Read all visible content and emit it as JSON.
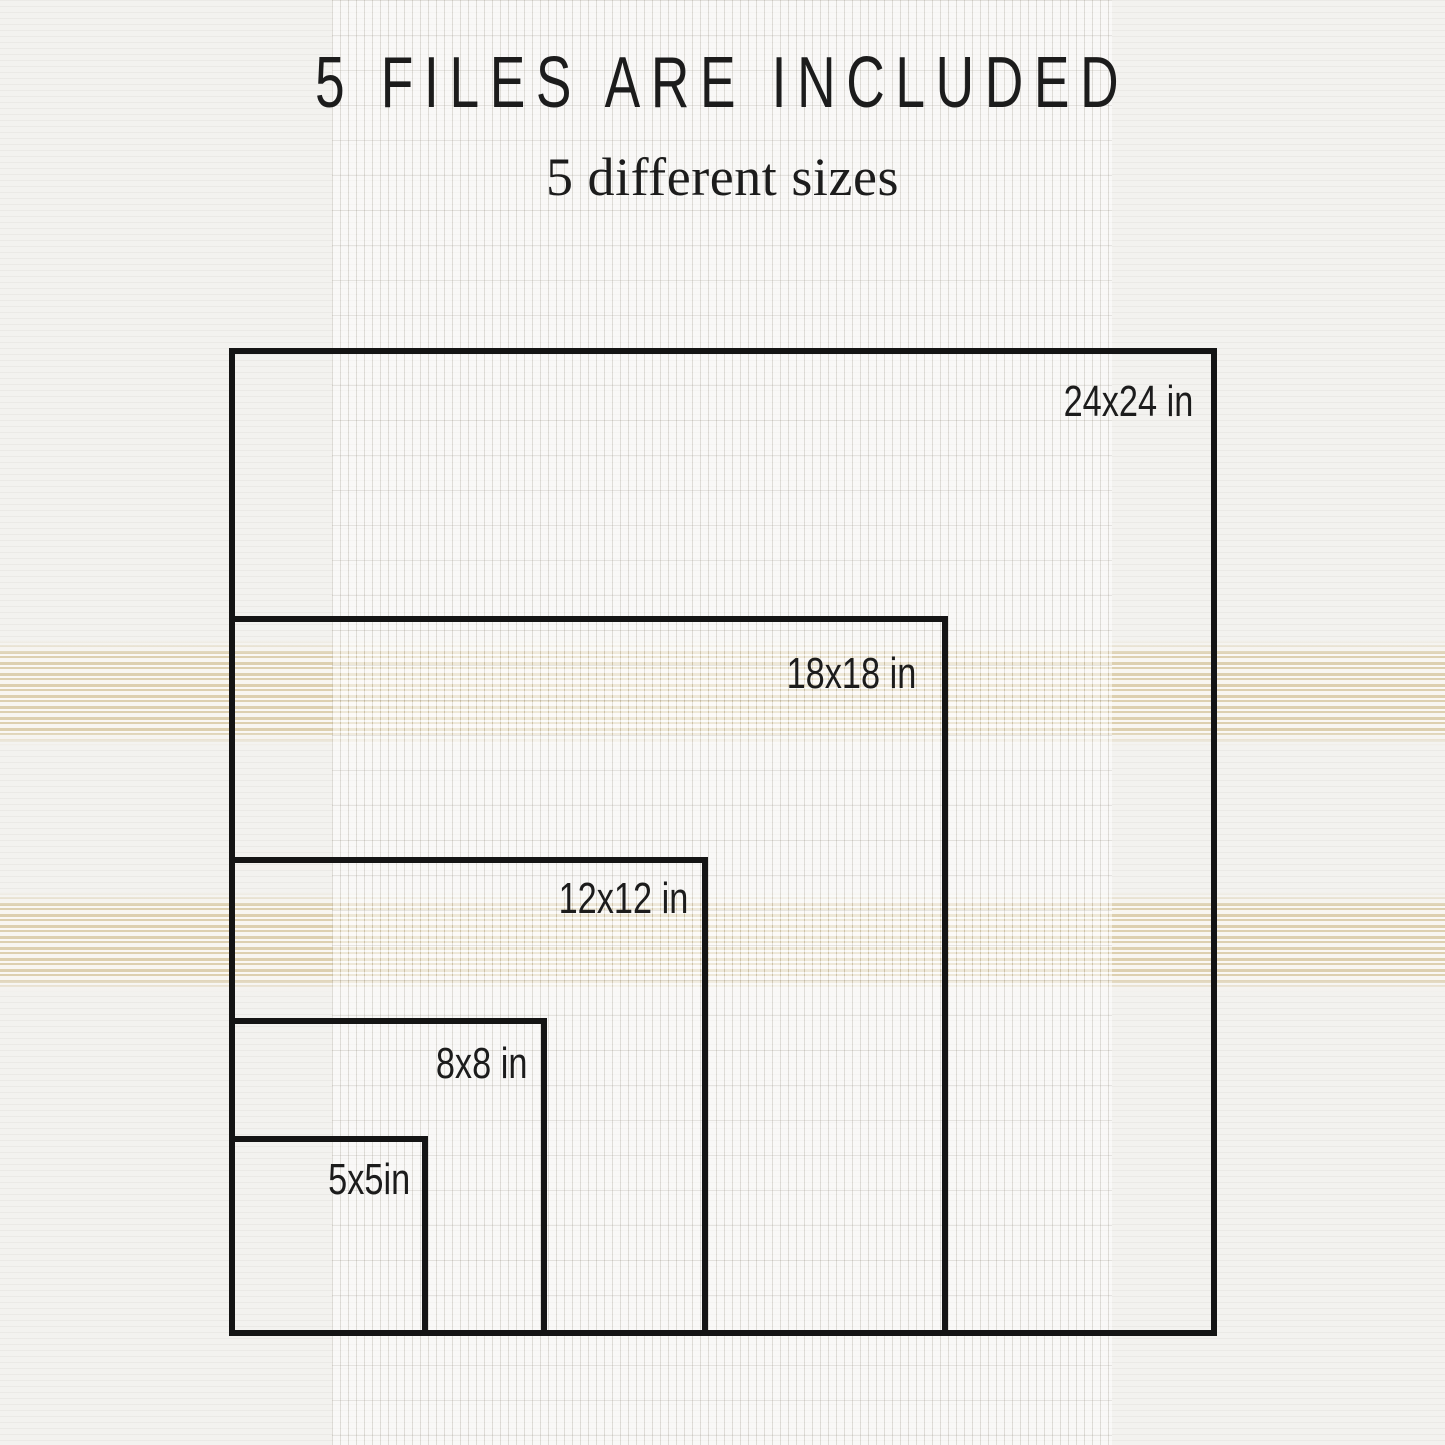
{
  "header": {
    "title": "5 FILES ARE INCLUDED",
    "subtitle": "5 different sizes"
  },
  "squares": [
    {
      "size": "24x24",
      "label": "24x24 in"
    },
    {
      "size": "18x18",
      "label": "18x18 in"
    },
    {
      "size": "12x12",
      "label": "12x12 in"
    },
    {
      "size": "8x8",
      "label": "8x8 in"
    },
    {
      "size": "5x5",
      "label": "5x5in"
    }
  ],
  "colors": {
    "background": "#f3f2ef",
    "border": "#141414",
    "text": "#1c1c1c",
    "stripe_beige": "#ddd0b0"
  }
}
